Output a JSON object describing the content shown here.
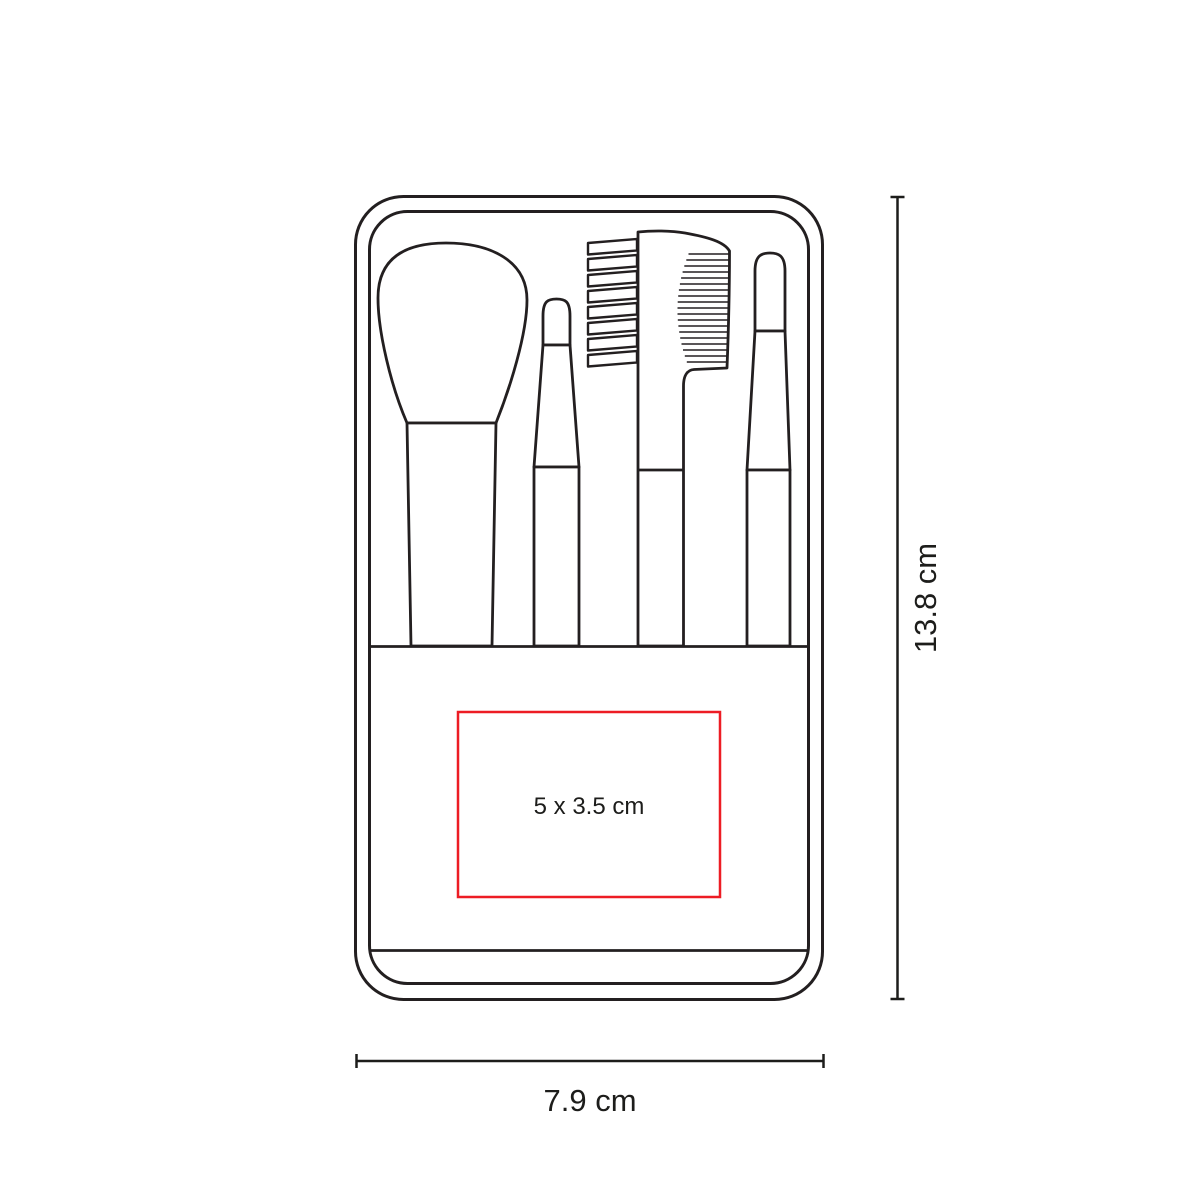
{
  "diagram": {
    "height_label": "13.8 cm",
    "width_label": "7.9 cm",
    "print_area_label": "5 x 3.5 cm"
  },
  "colors": {
    "outline": "#231f20",
    "text": "#1d1d1b",
    "print_area_red": "#ed1c24",
    "background": "#ffffff"
  }
}
